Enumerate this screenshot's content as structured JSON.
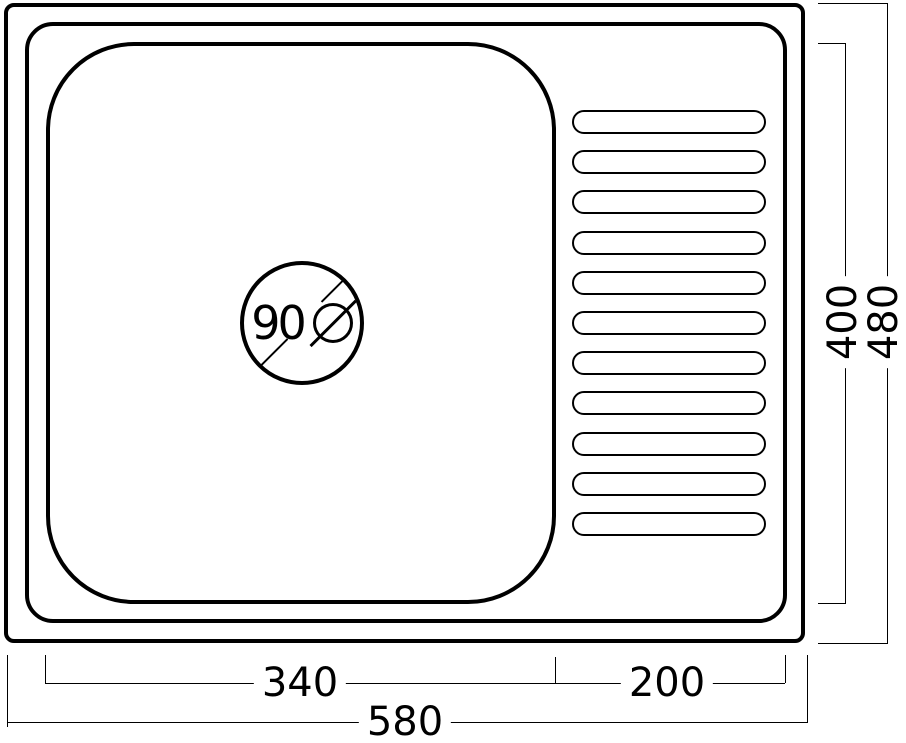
{
  "drawing": {
    "colors": {
      "line": "#000000",
      "background": "#ffffff"
    },
    "drain": {
      "number": "90",
      "symbol": "⌀",
      "label": "90⌀"
    },
    "drainboard": {
      "rib_count": 11
    }
  },
  "dimensions": {
    "bowl_width": {
      "label": "340",
      "orientation": "horizontal"
    },
    "drainboard_width": {
      "label": "200",
      "orientation": "horizontal"
    },
    "overall_width": {
      "label": "580",
      "orientation": "horizontal"
    },
    "bowl_depth": {
      "label": "400",
      "orientation": "vertical"
    },
    "overall_depth": {
      "label": "480",
      "orientation": "vertical"
    }
  }
}
